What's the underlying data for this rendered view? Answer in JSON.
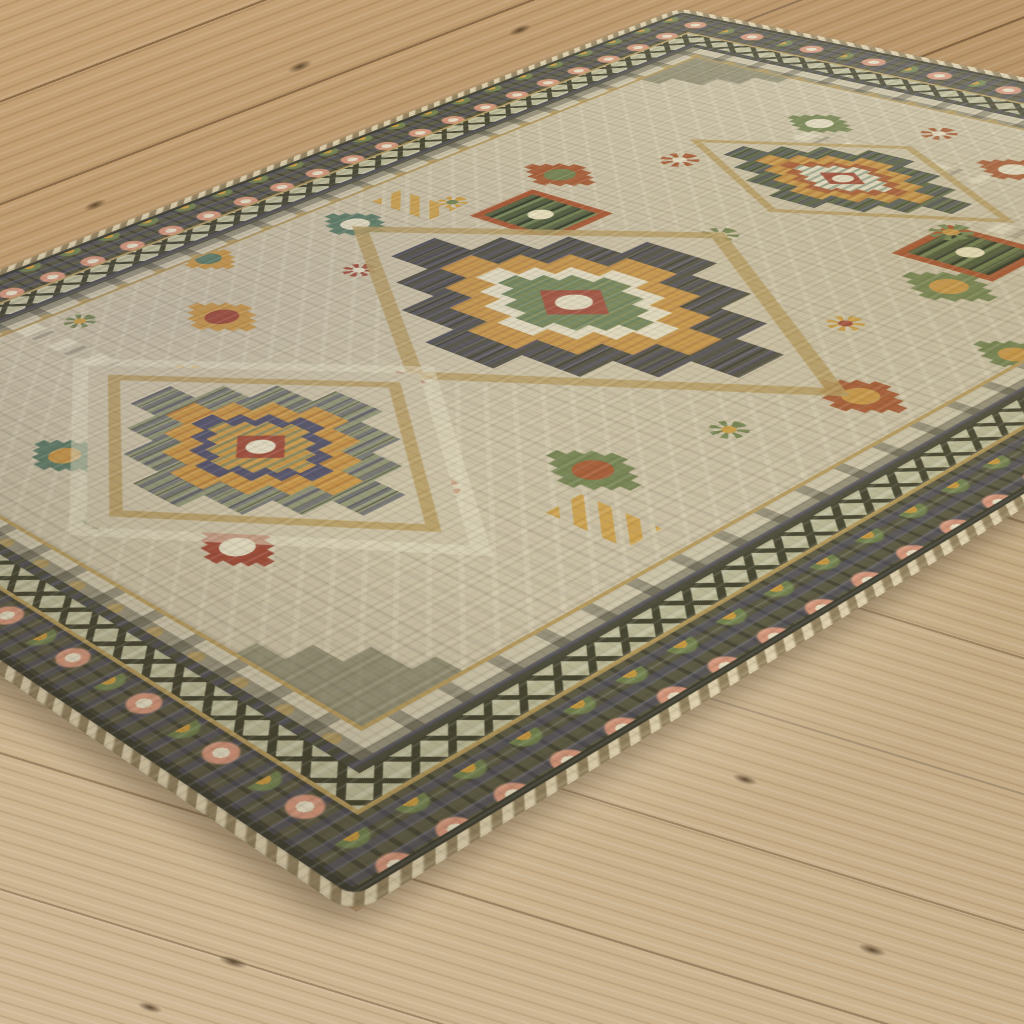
{
  "scene": {
    "description": "Angled photograph of a beige and sage tribal-style medallion area rug with rust, gold, olive-green and navy geometric motifs, lying diagonally on a light oak plank wood floor",
    "floor": {
      "material": "light oak wood planks",
      "regions": [
        "upper-left planks",
        "upper-right planks",
        "lower foreground planks"
      ],
      "knots": [
        {
          "x": 233,
          "y": 962,
          "w": 30,
          "h": 10,
          "angle": 17,
          "area": "bottom"
        },
        {
          "x": 150,
          "y": 1007,
          "w": 26,
          "h": 9,
          "angle": 17,
          "area": "bottom"
        },
        {
          "x": 745,
          "y": 779,
          "w": 26,
          "h": 9,
          "angle": 17,
          "area": "bottom"
        },
        {
          "x": 872,
          "y": 950,
          "w": 30,
          "h": 10,
          "angle": 17,
          "area": "bottom"
        },
        {
          "x": 300,
          "y": 66,
          "w": 26,
          "h": 9,
          "angle": -21,
          "area": "top"
        },
        {
          "x": 95,
          "y": 205,
          "w": 24,
          "h": 8,
          "angle": -21,
          "area": "top"
        },
        {
          "x": 520,
          "y": 30,
          "w": 24,
          "h": 8,
          "angle": -21,
          "area": "top"
        }
      ]
    },
    "rug": {
      "style": "tribal geometric medallion rug, beige field",
      "border_bands": [
        "tan braided binding",
        "thin dark edge line",
        "dark olive rosette border with cream, peach and gold flowers",
        "gold separator line",
        "sage band with dark zigzag chain",
        "dark guard stripe",
        "beige inner guard with dark comb motifs",
        "gold separator line",
        "beige main field"
      ],
      "medallions": [
        {
          "name": "top-medallion",
          "cx": 250,
          "cy": 178,
          "w": 135,
          "h": 80,
          "variant": "gold"
        },
        {
          "name": "center-medallion",
          "cx": 250,
          "cy": 375,
          "w": 210,
          "h": 150,
          "variant": "dark"
        },
        {
          "name": "bottom-medallion",
          "cx": 250,
          "cy": 568,
          "w": 150,
          "h": 115,
          "variant": "square"
        }
      ],
      "spandrels": [
        {
          "x": 70,
          "y": 70,
          "w": 130,
          "h": 96
        },
        {
          "x": 430,
          "y": 70,
          "w": 130,
          "h": 96
        },
        {
          "x": 70,
          "y": 680,
          "w": 130,
          "h": 96
        },
        {
          "x": 430,
          "y": 680,
          "w": 130,
          "h": 96
        }
      ],
      "motifs": [
        {
          "type": "diamond",
          "x": 135,
          "y": 258,
          "w": 44,
          "h": 32,
          "c1": "#a35a33",
          "c2": "#73814f"
        },
        {
          "type": "diamond",
          "x": 365,
          "y": 258,
          "w": 44,
          "h": 32,
          "c1": "#73814f",
          "c2": "#c59445"
        },
        {
          "type": "diamond",
          "x": 100,
          "y": 372,
          "w": 40,
          "h": 30,
          "c1": "#5d7a63",
          "c2": "#e0d8bc"
        },
        {
          "type": "diamond",
          "x": 402,
          "y": 372,
          "w": 40,
          "h": 30,
          "c1": "#a35a33",
          "c2": "#c59445"
        },
        {
          "type": "diamond",
          "x": 135,
          "y": 492,
          "w": 44,
          "h": 32,
          "c1": "#c59445",
          "c2": "#9c4a36"
        },
        {
          "type": "diamond",
          "x": 365,
          "y": 492,
          "w": 44,
          "h": 32,
          "c1": "#73814f",
          "c2": "#a35a33"
        },
        {
          "type": "diamond",
          "x": 193,
          "y": 120,
          "w": 38,
          "h": 28,
          "c1": "#73814f",
          "c2": "#e0d8bc"
        },
        {
          "type": "diamond",
          "x": 307,
          "y": 120,
          "w": 38,
          "h": 28,
          "c1": "#a35a33",
          "c2": "#e0d8bc"
        },
        {
          "type": "diamond",
          "x": 193,
          "y": 630,
          "w": 38,
          "h": 28,
          "c1": "#5d7a63",
          "c2": "#c59445"
        },
        {
          "type": "diamond",
          "x": 307,
          "y": 630,
          "w": 38,
          "h": 28,
          "c1": "#9c4a36",
          "c2": "#e0d8bc"
        },
        {
          "type": "diamond",
          "x": 425,
          "y": 300,
          "w": 36,
          "h": 26,
          "c1": "#73814f",
          "c2": "#c59445"
        },
        {
          "type": "diamond",
          "x": 75,
          "y": 450,
          "w": 36,
          "h": 26,
          "c1": "#c59445",
          "c2": "#5d7a63"
        },
        {
          "type": "square",
          "x": 160,
          "y": 300,
          "w": 44,
          "h": 36,
          "c1": "#a5542e",
          "c2": "#4f5a38"
        },
        {
          "type": "square",
          "x": 345,
          "y": 215,
          "w": 42,
          "h": 34,
          "c1": "#a5542e",
          "c2": "#4f5a38"
        },
        {
          "type": "square",
          "x": 210,
          "y": 558,
          "w": 42,
          "h": 34,
          "c1": "#a5542e",
          "c2": "#4f5a38"
        },
        {
          "type": "flower",
          "x": 170,
          "y": 205,
          "s": 20,
          "c1": "#a35a33",
          "c2": "#e0d8bc"
        },
        {
          "type": "flower",
          "x": 330,
          "y": 205,
          "s": 20,
          "c1": "#73814f",
          "c2": "#c59445"
        },
        {
          "type": "flower",
          "x": 170,
          "y": 545,
          "s": 20,
          "c1": "#c99b43",
          "c2": "#9c4a36"
        },
        {
          "type": "flower",
          "x": 330,
          "y": 545,
          "s": 20,
          "c1": "#a35a33",
          "c2": "#e0d8bc"
        },
        {
          "type": "flower",
          "x": 250,
          "y": 272,
          "s": 18,
          "c1": "#73814f",
          "c2": "#e0d8bc"
        },
        {
          "type": "flower",
          "x": 250,
          "y": 478,
          "s": 18,
          "c1": "#9c4a36",
          "c2": "#e0d8bc"
        },
        {
          "type": "flower",
          "x": 118,
          "y": 320,
          "s": 16,
          "c1": "#c99b43",
          "c2": "#73814f"
        },
        {
          "type": "flower",
          "x": 382,
          "y": 430,
          "s": 16,
          "c1": "#73814f",
          "c2": "#c99b43"
        },
        {
          "type": "flower",
          "x": 145,
          "y": 412,
          "s": 16,
          "c1": "#9c4a36",
          "c2": "#e0d8bc"
        },
        {
          "type": "flower",
          "x": 355,
          "y": 318,
          "s": 16,
          "c1": "#c99b43",
          "c2": "#9c4a36"
        },
        {
          "type": "flower",
          "x": 250,
          "y": 652,
          "s": 18,
          "c1": "#73814f",
          "c2": "#e0d8bc"
        },
        {
          "type": "flower",
          "x": 250,
          "y": 98,
          "s": 18,
          "c1": "#a35a33",
          "c2": "#e0d8bc"
        },
        {
          "type": "flower",
          "x": 85,
          "y": 540,
          "s": 16,
          "c1": "#73814f",
          "c2": "#c99b43"
        },
        {
          "type": "flower",
          "x": 415,
          "y": 210,
          "s": 16,
          "c1": "#9c4a36",
          "c2": "#e0d8bc"
        },
        {
          "type": "dash",
          "x": 250,
          "y": 332,
          "w": 130,
          "h": 13
        },
        {
          "type": "dash",
          "x": 250,
          "y": 422,
          "w": 130,
          "h": 13
        },
        {
          "type": "dash",
          "x": 115,
          "y": 562,
          "w": 90,
          "h": 12
        },
        {
          "type": "dash",
          "x": 385,
          "y": 188,
          "w": 90,
          "h": 12
        },
        {
          "type": "dash",
          "x": 250,
          "y": 140,
          "w": 110,
          "h": 12
        },
        {
          "type": "dash",
          "x": 250,
          "y": 610,
          "w": 110,
          "h": 12
        },
        {
          "type": "hook",
          "x": 105,
          "y": 335,
          "w": 42,
          "h": 20
        },
        {
          "type": "hook",
          "x": 260,
          "y": 208,
          "w": 38,
          "h": 18
        },
        {
          "type": "hook",
          "x": 395,
          "y": 520,
          "w": 40,
          "h": 20
        }
      ]
    }
  },
  "palette": {
    "wood_top": "#b8956a",
    "wood_seam": "#7d6243",
    "wood_bottom": "#c9b18e",
    "binding": "#b7a67e",
    "border_dark": "#5e5b44",
    "border_navy": "#555266",
    "border_sage": "#b7b491",
    "zigzag_dark": "#45442f",
    "comb_bg": "#c9c0a4",
    "gold_line": "#b3985c",
    "rug_field": "#c8bda0",
    "medallion_dark": "#4f4d3f",
    "medallion_navy": "#525064",
    "medallion_gold": "#c59445",
    "medallion_rust": "#a35a33",
    "medallion_green": "#73814f",
    "medallion_teal": "#5d7a63",
    "medallion_cream": "#e0d8bc",
    "center_red": "#9c4a36",
    "sage_dark": "#8f9170",
    "rosette_peach": "#d3967a",
    "rosette_gold": "#c99b43",
    "rosette_cream": "#e4dbbf",
    "spandrel": "#6e6c51",
    "shadow_color": "#3a2d1d"
  }
}
